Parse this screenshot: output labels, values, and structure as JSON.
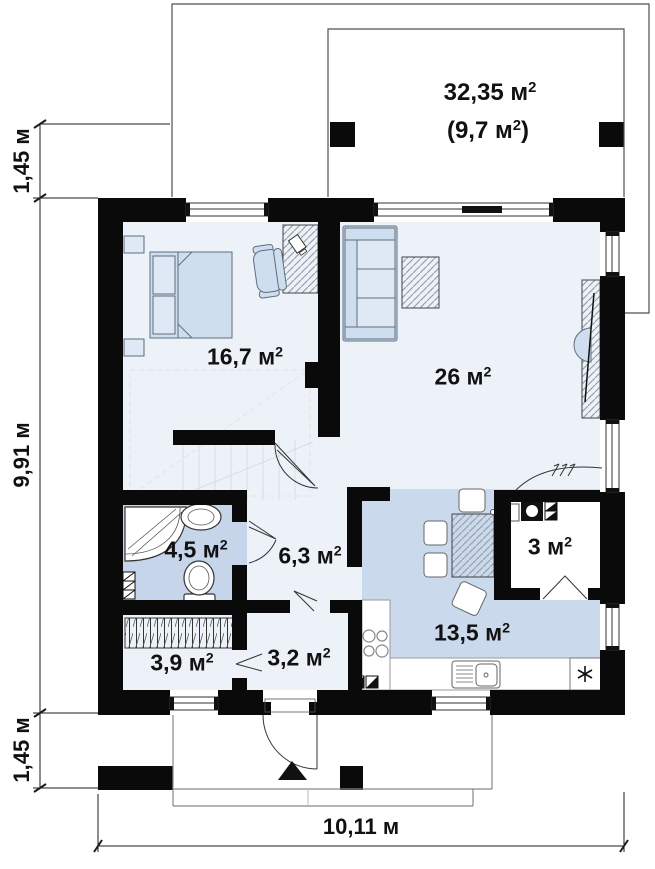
{
  "plan": {
    "rooms": {
      "terrace": {
        "area": "32,35 м",
        "sup": "2"
      },
      "terrace_covered": {
        "area": "(9,7 м",
        "sup": "2",
        "tail": ")"
      },
      "bedroom": {
        "area": "16,7 м",
        "sup": "2"
      },
      "living": {
        "area": "26 м",
        "sup": "2"
      },
      "bathroom": {
        "area": "4,5 м",
        "sup": "2"
      },
      "hall": {
        "area": "6,3 м",
        "sup": "2"
      },
      "pantry": {
        "area": "3 м",
        "sup": "2"
      },
      "kitchen": {
        "area": "13,5 м",
        "sup": "2"
      },
      "wardrobe": {
        "area": "3,9 м",
        "sup": "2"
      },
      "entry": {
        "area": "3,2 м",
        "sup": "2"
      }
    },
    "dimensions": {
      "top_left": "1,45 м",
      "left": "9,91 м",
      "bottom_left": "1,45 м",
      "bottom": "10,11 м"
    }
  },
  "colors": {
    "wall": "#0a0a0a",
    "floor_light": "#edf2f9",
    "floor_kitchen": "#cbd9ec",
    "floor_bath": "#c6d5ea",
    "furniture_fill": "#cfdeef",
    "furniture_stroke": "#5f6d7d",
    "text": "#111111"
  }
}
